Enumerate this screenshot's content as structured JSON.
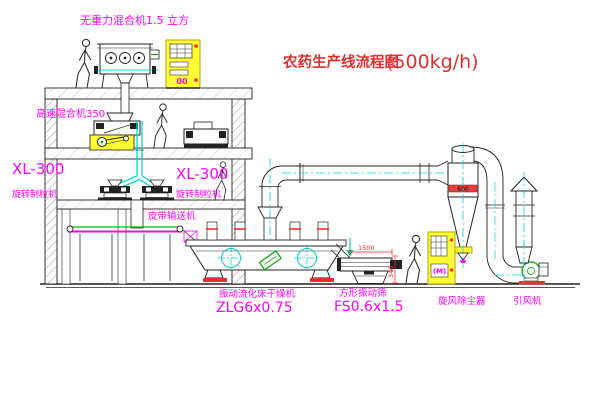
{
  "drawing": {
    "title": "农药生产线流程图",
    "capacity": "(500kg/h)"
  },
  "labels": {
    "gravity_mixer": "无重力混合机1.5 立方",
    "high_speed_mixer": "高速混合机350",
    "granulator_left_model": "XL-300",
    "granulator_left_name": "旋转制粒机",
    "granulator_right_model": "XL-300",
    "granulator_right_name": "旋转制粒机",
    "belt_conveyor": "皮带输送机",
    "dryer_name": "振动流化床干燥机",
    "dryer_model": "ZLG6x0.75",
    "sieve_name": "方形振动筛",
    "sieve_model": "FS0.6x1.5",
    "cyclone": "旋风除尘器",
    "fan": "引风机"
  },
  "annotations": {
    "cyclone_band": "600",
    "sieve_width_dim": "1500",
    "sieve_height_dim": "340",
    "top_panel_display": "00",
    "right_panel_display": "(M)"
  },
  "colors": {
    "label_magenta": "#FF00FF",
    "title_red": "#E03030",
    "cabinet_yellow": "#FFFF33",
    "centerline_cyan": "#00D8D8",
    "machine_green": "#00AA00",
    "dimension_red": "#FF2020"
  }
}
